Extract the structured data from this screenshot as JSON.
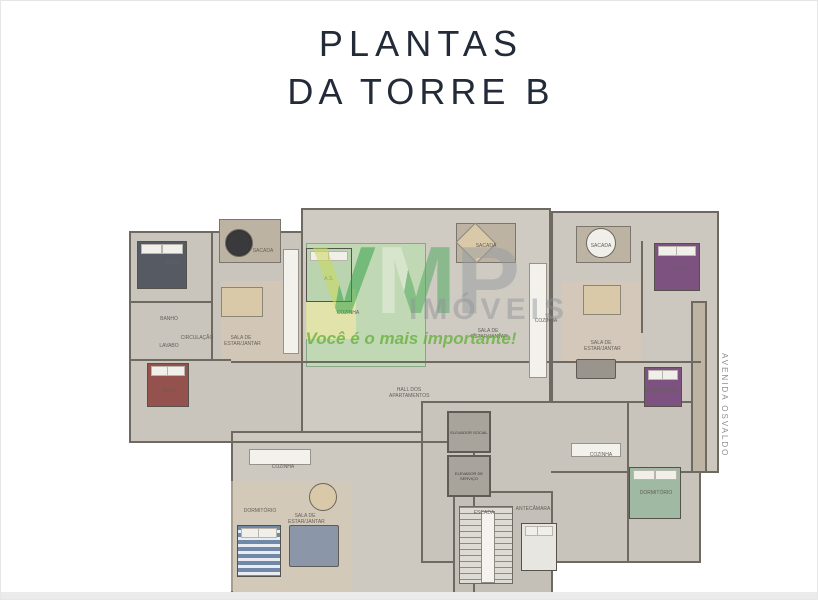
{
  "page": {
    "title_line1": "PLANTAS",
    "title_line2": "DA TORRE B",
    "street_label": "AVENIDA OSVALDO REIS"
  },
  "watermark": {
    "letters": [
      "V",
      "M",
      "P"
    ],
    "brand_sub": "IMÓVEIS",
    "slogan": "Você é o mais importante!",
    "accent_green": "#37a34b",
    "accent_yellow_green": "#ccd95c",
    "accent_gray": "#9aa0a6"
  },
  "floorplan": {
    "wall_color": "#6e6a62",
    "floor_color": "#ccc8c0",
    "highlight_room_color": "#bedab2",
    "rooms": {
      "suite_tl": "SUITE",
      "banho_tl": "BANHO",
      "lavabo_tl": "LAVABO",
      "suite_ml": "SUITE",
      "circulacao_l": "CIRCULAÇÃO",
      "sala_l": "SALA DE ESTAR/JANTAR",
      "sacada_tl": "SACADA",
      "as_g": "A.S.",
      "cozinha_g": "COZINHA",
      "sala_c": "SALA DE ESTAR/JANTAR",
      "sacada_tc": "SACADA",
      "sacada_tc2": "SACADA",
      "cozinha_c": "COZINHA",
      "suite_tr": "SUITE",
      "sala_r": "SALA DE ESTAR/JANTAR",
      "dormitorio_mr": "DORMITÓRIO",
      "hall": "HALL DOS APARTAMENTOS",
      "elev_social": "ELEVADOR SOCIAL",
      "elev_servico": "ELEVADOR DE SERVIÇO",
      "escada": "ESCADA",
      "antecamara": "ANTECÂMARA",
      "cozinha_bl": "COZINHA",
      "sala_bl": "SALA DE ESTAR/JANTAR",
      "dormitorio_bl": "DORMITÓRIO",
      "cozinha_br": "COZINHA",
      "dormitorio_br": "DORMITÓRIO"
    }
  }
}
